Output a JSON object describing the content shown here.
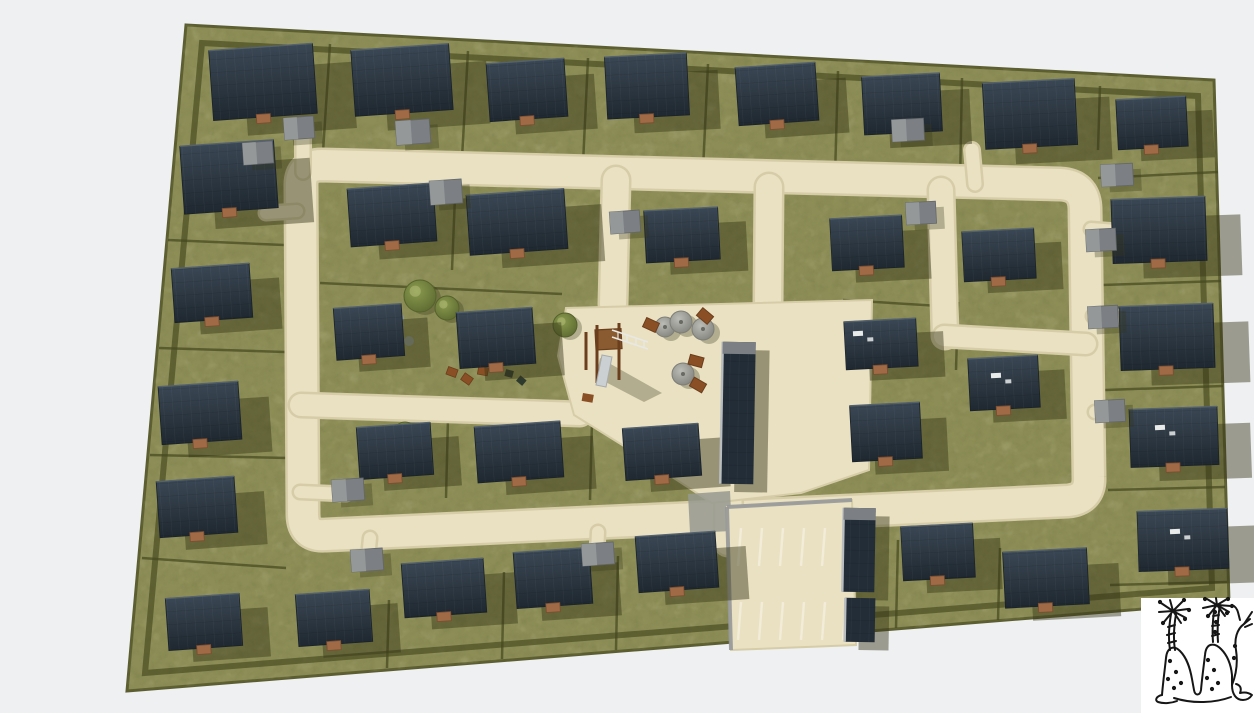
{
  "scene": {
    "kind": "aerial-3d-site-plan-render",
    "subject": "housing-development"
  },
  "canvas": {
    "width": 1254,
    "height": 713,
    "background": "#eef0f2"
  },
  "colors": {
    "background": "#eef0f2",
    "grass": "#8d8e57",
    "grass_dark_speck": "#4a4b26",
    "grass_light_speck": "#b8b377",
    "hedge": "#45481f",
    "boundary": "#5c5e31",
    "road": "#e9e1c2",
    "road_edge": "#d6cca8",
    "roof_dark": "#232d37",
    "roof_grad_top": "#3a4754",
    "roof_grad_bottom": "#1f2830",
    "ridge_light": "#55626e",
    "garage_gray": "#7c8084",
    "garage_light": "#949899",
    "shadow": "rgba(54,54,22,0.45)",
    "shadow_soft": "rgba(54,54,22,0.30)",
    "wood": "#8a5a30",
    "wood_dark": "#6b3f1d",
    "table_brown": "#8a4f24",
    "tree_green": "#6d7c3c",
    "tree_green_dark": "#55622c",
    "tree_gray": "#a3a39d",
    "tree_gray_dark": "#7e7e78",
    "porch_brown": "#a06a46",
    "parking_stripe": "#f2ecd8",
    "curb_gray": "#97999a",
    "asphalt": "#96998f",
    "slide_gray": "#cbd0d2",
    "vent_white": "#e9ebea",
    "sketch_ink": "#161616",
    "sketch_paper": "#ffffff"
  },
  "site": {
    "outline": "186,25 1214,80 1229,602 127,691",
    "hedge_inset": "202,43 1198,96 1212,588 145,673"
  },
  "roads": {
    "ring": {
      "d": "M 322,165 L 1060,184 Q 1084,185 1085,208 L 1089,477 Q 1090,499 1068,501 L 326,535 Q 303,537 303,514 L 301,187 Q 300,165 322,165 Z",
      "w": 30
    },
    "lanes": [
      {
        "d": "M 616,180 L 613,304",
        "w": 26
      },
      {
        "d": "M 769,187 L 768,304",
        "w": 26
      },
      {
        "d": "M 941,190 L 945,336",
        "w": 24
      },
      {
        "d": "M 944,336 L 1086,344",
        "w": 20
      },
      {
        "d": "M 301,405 L 580,414",
        "w": 22
      },
      {
        "d": "M 729,468 L 728,542",
        "w": 26
      }
    ],
    "driveways": [
      {
        "d": "M 303,172 L 303,130",
        "w": 13
      },
      {
        "d": "M 975,184 L 972,150",
        "w": 13
      },
      {
        "d": "M 297,211 L 266,213",
        "w": 12
      },
      {
        "d": "M 300,492 L 346,494",
        "w": 12
      },
      {
        "d": "M 370,538 L 368,558",
        "w": 12
      },
      {
        "d": "M 598,532 L 597,552",
        "w": 12
      },
      {
        "d": "M 1091,229 L 1116,231",
        "w": 12
      },
      {
        "d": "M 1093,316 L 1117,317",
        "w": 12
      },
      {
        "d": "M 1095,412 L 1116,412",
        "w": 12
      }
    ],
    "plaza": "566,308 872,300 869,470 801,493 712,503 640,456 574,415 558,356",
    "asphalt_patch": "688,494 730,491 732,531 690,533"
  },
  "parking": {
    "outline": "727,507 852,500 856,645 731,650",
    "stall_xs": [
      738,
      759,
      780,
      801,
      822,
      843
    ],
    "row_top": {
      "y1": 528,
      "y2": 566
    },
    "row_bottom": {
      "y1": 602,
      "y2": 640
    },
    "skew": 3,
    "curbs": [
      [
        727,
        507,
        852,
        500
      ],
      [
        727,
        507,
        731,
        650
      ]
    ]
  },
  "houses": [
    [
      263,
      82,
      104,
      70,
      -4
    ],
    [
      402,
      80,
      98,
      66,
      -4
    ],
    [
      527,
      90,
      78,
      58,
      -4
    ],
    [
      647,
      86,
      82,
      62,
      -3
    ],
    [
      777,
      94,
      80,
      58,
      -4
    ],
    [
      902,
      104,
      78,
      58,
      -3
    ],
    [
      1030,
      114,
      92,
      66,
      -3
    ],
    [
      1152,
      123,
      70,
      50,
      -3
    ],
    [
      1159,
      230,
      94,
      64,
      -2
    ],
    [
      1167,
      337,
      94,
      64,
      -2
    ],
    [
      1174,
      437,
      88,
      58,
      -2
    ],
    [
      1183,
      540,
      90,
      60,
      -2
    ],
    [
      229,
      177,
      94,
      68,
      -4
    ],
    [
      212,
      293,
      78,
      54,
      -4
    ],
    [
      200,
      413,
      80,
      58,
      -4
    ],
    [
      197,
      507,
      78,
      56,
      -4
    ],
    [
      204,
      622,
      74,
      52,
      -4
    ],
    [
      334,
      618,
      74,
      52,
      -4
    ],
    [
      444,
      588,
      82,
      54,
      -4
    ],
    [
      553,
      578,
      76,
      56,
      -4
    ],
    [
      677,
      562,
      80,
      56,
      -4
    ],
    [
      938,
      552,
      72,
      54,
      -3
    ],
    [
      1046,
      578,
      84,
      56,
      -3
    ],
    [
      392,
      215,
      86,
      58,
      -4
    ],
    [
      517,
      222,
      98,
      60,
      -4
    ],
    [
      682,
      235,
      74,
      52,
      -3
    ],
    [
      867,
      243,
      72,
      52,
      -3
    ],
    [
      999,
      255,
      72,
      50,
      -3
    ],
    [
      369,
      332,
      68,
      52,
      -4
    ],
    [
      496,
      338,
      76,
      56,
      -4
    ],
    [
      881,
      344,
      72,
      48,
      -3
    ],
    [
      1004,
      383,
      70,
      52,
      -3
    ],
    [
      886,
      432,
      70,
      56,
      -3
    ],
    [
      395,
      451,
      74,
      52,
      -4
    ],
    [
      519,
      452,
      86,
      56,
      -4
    ],
    [
      662,
      452,
      76,
      52,
      -4
    ]
  ],
  "garages": [
    [
      413,
      132,
      34,
      24,
      -4
    ],
    [
      446,
      192,
      32,
      24,
      -4
    ],
    [
      625,
      222,
      30,
      22,
      -4
    ],
    [
      908,
      130,
      32,
      22,
      -3
    ],
    [
      299,
      128,
      30,
      22,
      -4
    ],
    [
      258,
      153,
      30,
      22,
      -4
    ],
    [
      1117,
      175,
      32,
      22,
      -3
    ],
    [
      1101,
      240,
      30,
      22,
      -3
    ],
    [
      1103,
      317,
      30,
      22,
      -3
    ],
    [
      1110,
      411,
      30,
      22,
      -3
    ],
    [
      348,
      490,
      32,
      22,
      -4
    ],
    [
      367,
      560,
      32,
      22,
      -4
    ],
    [
      598,
      554,
      32,
      22,
      -4
    ],
    [
      921,
      213,
      30,
      22,
      -3
    ]
  ],
  "community_buildings": [
    {
      "x": 738,
      "y": 413,
      "w": 33,
      "h": 142,
      "rot": 1,
      "cap": true
    },
    {
      "x": 859,
      "y": 550,
      "w": 32,
      "h": 84,
      "rot": 1,
      "cap": true
    },
    {
      "x": 860,
      "y": 620,
      "w": 30,
      "h": 44,
      "rot": 1,
      "cap": false
    }
  ],
  "roof_vents": [
    [
      858,
      334
    ],
    [
      996,
      376
    ],
    [
      1160,
      428
    ],
    [
      1175,
      532
    ]
  ],
  "lot_dividers": [
    [
      330,
      44,
      323,
      152
    ],
    [
      468,
      51,
      462,
      158
    ],
    [
      588,
      58,
      583,
      164
    ],
    [
      708,
      64,
      703,
      170
    ],
    [
      838,
      71,
      835,
      176
    ],
    [
      962,
      78,
      960,
      183
    ],
    [
      1100,
      86,
      1098,
      150
    ],
    [
      168,
      240,
      284,
      245
    ],
    [
      159,
      348,
      285,
      352
    ],
    [
      150,
      455,
      287,
      458
    ],
    [
      142,
      558,
      286,
      568
    ],
    [
      1098,
      178,
      1218,
      172
    ],
    [
      1102,
      285,
      1221,
      281
    ],
    [
      1105,
      390,
      1223,
      386
    ],
    [
      1108,
      490,
      1225,
      487
    ],
    [
      1110,
      585,
      1227,
      582
    ],
    [
      389,
      600,
      387,
      668
    ],
    [
      504,
      572,
      502,
      659
    ],
    [
      618,
      556,
      616,
      650
    ],
    [
      898,
      540,
      896,
      628
    ],
    [
      1000,
      548,
      998,
      620
    ],
    [
      455,
      196,
      452,
      270
    ],
    [
      320,
      283,
      562,
      294
    ],
    [
      448,
      418,
      446,
      498
    ],
    [
      592,
      420,
      590,
      500
    ],
    [
      843,
      300,
      940,
      306
    ],
    [
      958,
      302,
      956,
      370
    ]
  ],
  "park": {
    "green_trees": [
      [
        420,
        296,
        16
      ],
      [
        447,
        308,
        12
      ],
      [
        565,
        325,
        12
      ],
      [
        405,
        433,
        11
      ]
    ],
    "bushes": [
      [
        399,
        318,
        5
      ],
      [
        409,
        341,
        5
      ],
      [
        392,
        353,
        4
      ],
      [
        500,
        331,
        5
      ]
    ],
    "seats_brown": [
      [
        452,
        372,
        20
      ],
      [
        467,
        379,
        35
      ],
      [
        483,
        371,
        10
      ]
    ],
    "seats_dark": [
      [
        509,
        374,
        15
      ],
      [
        521,
        381,
        40
      ]
    ]
  },
  "plaza_items": {
    "gray_trees": [
      [
        665,
        327,
        10
      ],
      [
        681,
        322,
        11
      ],
      [
        703,
        329,
        11
      ],
      [
        683,
        374,
        11
      ]
    ],
    "picnic_tables": [
      [
        651,
        325,
        25
      ],
      [
        705,
        316,
        40
      ],
      [
        696,
        361,
        15
      ],
      [
        698,
        385,
        30
      ]
    ]
  },
  "playground": {
    "shadow": "600,358 662,393 644,402 596,377",
    "posts": [
      [
        597,
        325,
        597,
        383
      ],
      [
        619,
        323,
        619,
        380
      ],
      [
        586,
        332,
        586,
        370
      ]
    ],
    "rails": [
      [
        612,
        330,
        648,
        342
      ],
      [
        612,
        337,
        648,
        349
      ]
    ],
    "rungs": [
      [
        618,
        332,
        618,
        339
      ],
      [
        627,
        335,
        627,
        342
      ],
      [
        636,
        338,
        636,
        345
      ],
      [
        644,
        340,
        644,
        347
      ]
    ],
    "platform": [
      595,
      330,
      26,
      20
    ],
    "slide": "602,355 612,357 606,387 596,385",
    "bench": [
      583,
      393,
      11,
      8
    ]
  },
  "logo": {
    "origin": [
      1141,
      598
    ],
    "box": [
      0,
      0,
      113,
      115
    ],
    "paths": [
      "M29,52 C27,40 28,28 30,16",
      "M34,52 C32,40 33,28 35,16",
      "M27,45 L35,43",
      "M26,37 L34,35",
      "M27,29 L34,27",
      "M32,13 L20,5",
      "M32,13 L29,2",
      "M32,13 L42,3",
      "M32,13 L47,11",
      "M32,13 L18,14",
      "M32,13 L45,20",
      "M32,13 L23,24",
      "M32,13 L40,25",
      "M72,44 C71,30 72,18 74,7",
      "M77,44 C76,30 77,18 79,7",
      "M71,38 L78,36",
      "M71,28 L78,27",
      "M72,18 L78,17",
      "M76,7 L66,1",
      "M76,7 L75,0",
      "M76,7 L86,1",
      "M76,7 L90,8",
      "M76,7 L62,10",
      "M76,7 L88,14",
      "M76,7 L68,17",
      "M76,7 L84,18",
      "M21,97 C22,84 24,70 25,60 C26,49 33,47 39,53 C46,60 49,70 51,81 L53,92 C54,98 59,98 60,92 C61,80 63,66 64,57 C65,45 73,44 80,51 C87,58 90,67 91,77 L91,87",
      "M21,97 C16,98 13,102 17,104 C23,106 31,105 36,103",
      "M33,100 C52,106 74,105 90,99",
      "M91,87 C95,77 97,65 95,52 C93,41 96,31 103,26 L109,21",
      "M103,26 L111,14",
      "M104,29 L111,26",
      "M99,22 C97,15 97,11 93,8",
      "M91,87 C91,96 95,102 102,102 C106,102 109,100 111,97 C107,94 103,94 99,95 C101,90 99,87 95,86"
    ],
    "dots": [
      [
        29,
        63
      ],
      [
        35,
        74
      ],
      [
        27,
        81
      ],
      [
        40,
        85
      ],
      [
        33,
        90
      ],
      [
        67,
        62
      ],
      [
        73,
        72
      ],
      [
        66,
        80
      ],
      [
        77,
        85
      ],
      [
        71,
        91
      ],
      [
        93,
        60
      ],
      [
        94,
        48
      ],
      [
        19,
        4
      ],
      [
        43,
        2
      ],
      [
        48,
        12
      ],
      [
        22,
        25
      ],
      [
        44,
        21
      ],
      [
        64,
        1
      ],
      [
        87,
        1
      ],
      [
        91,
        8
      ],
      [
        67,
        18
      ],
      [
        86,
        15
      ],
      [
        74,
        14
      ],
      [
        75,
        24
      ],
      [
        74,
        34
      ]
    ]
  }
}
